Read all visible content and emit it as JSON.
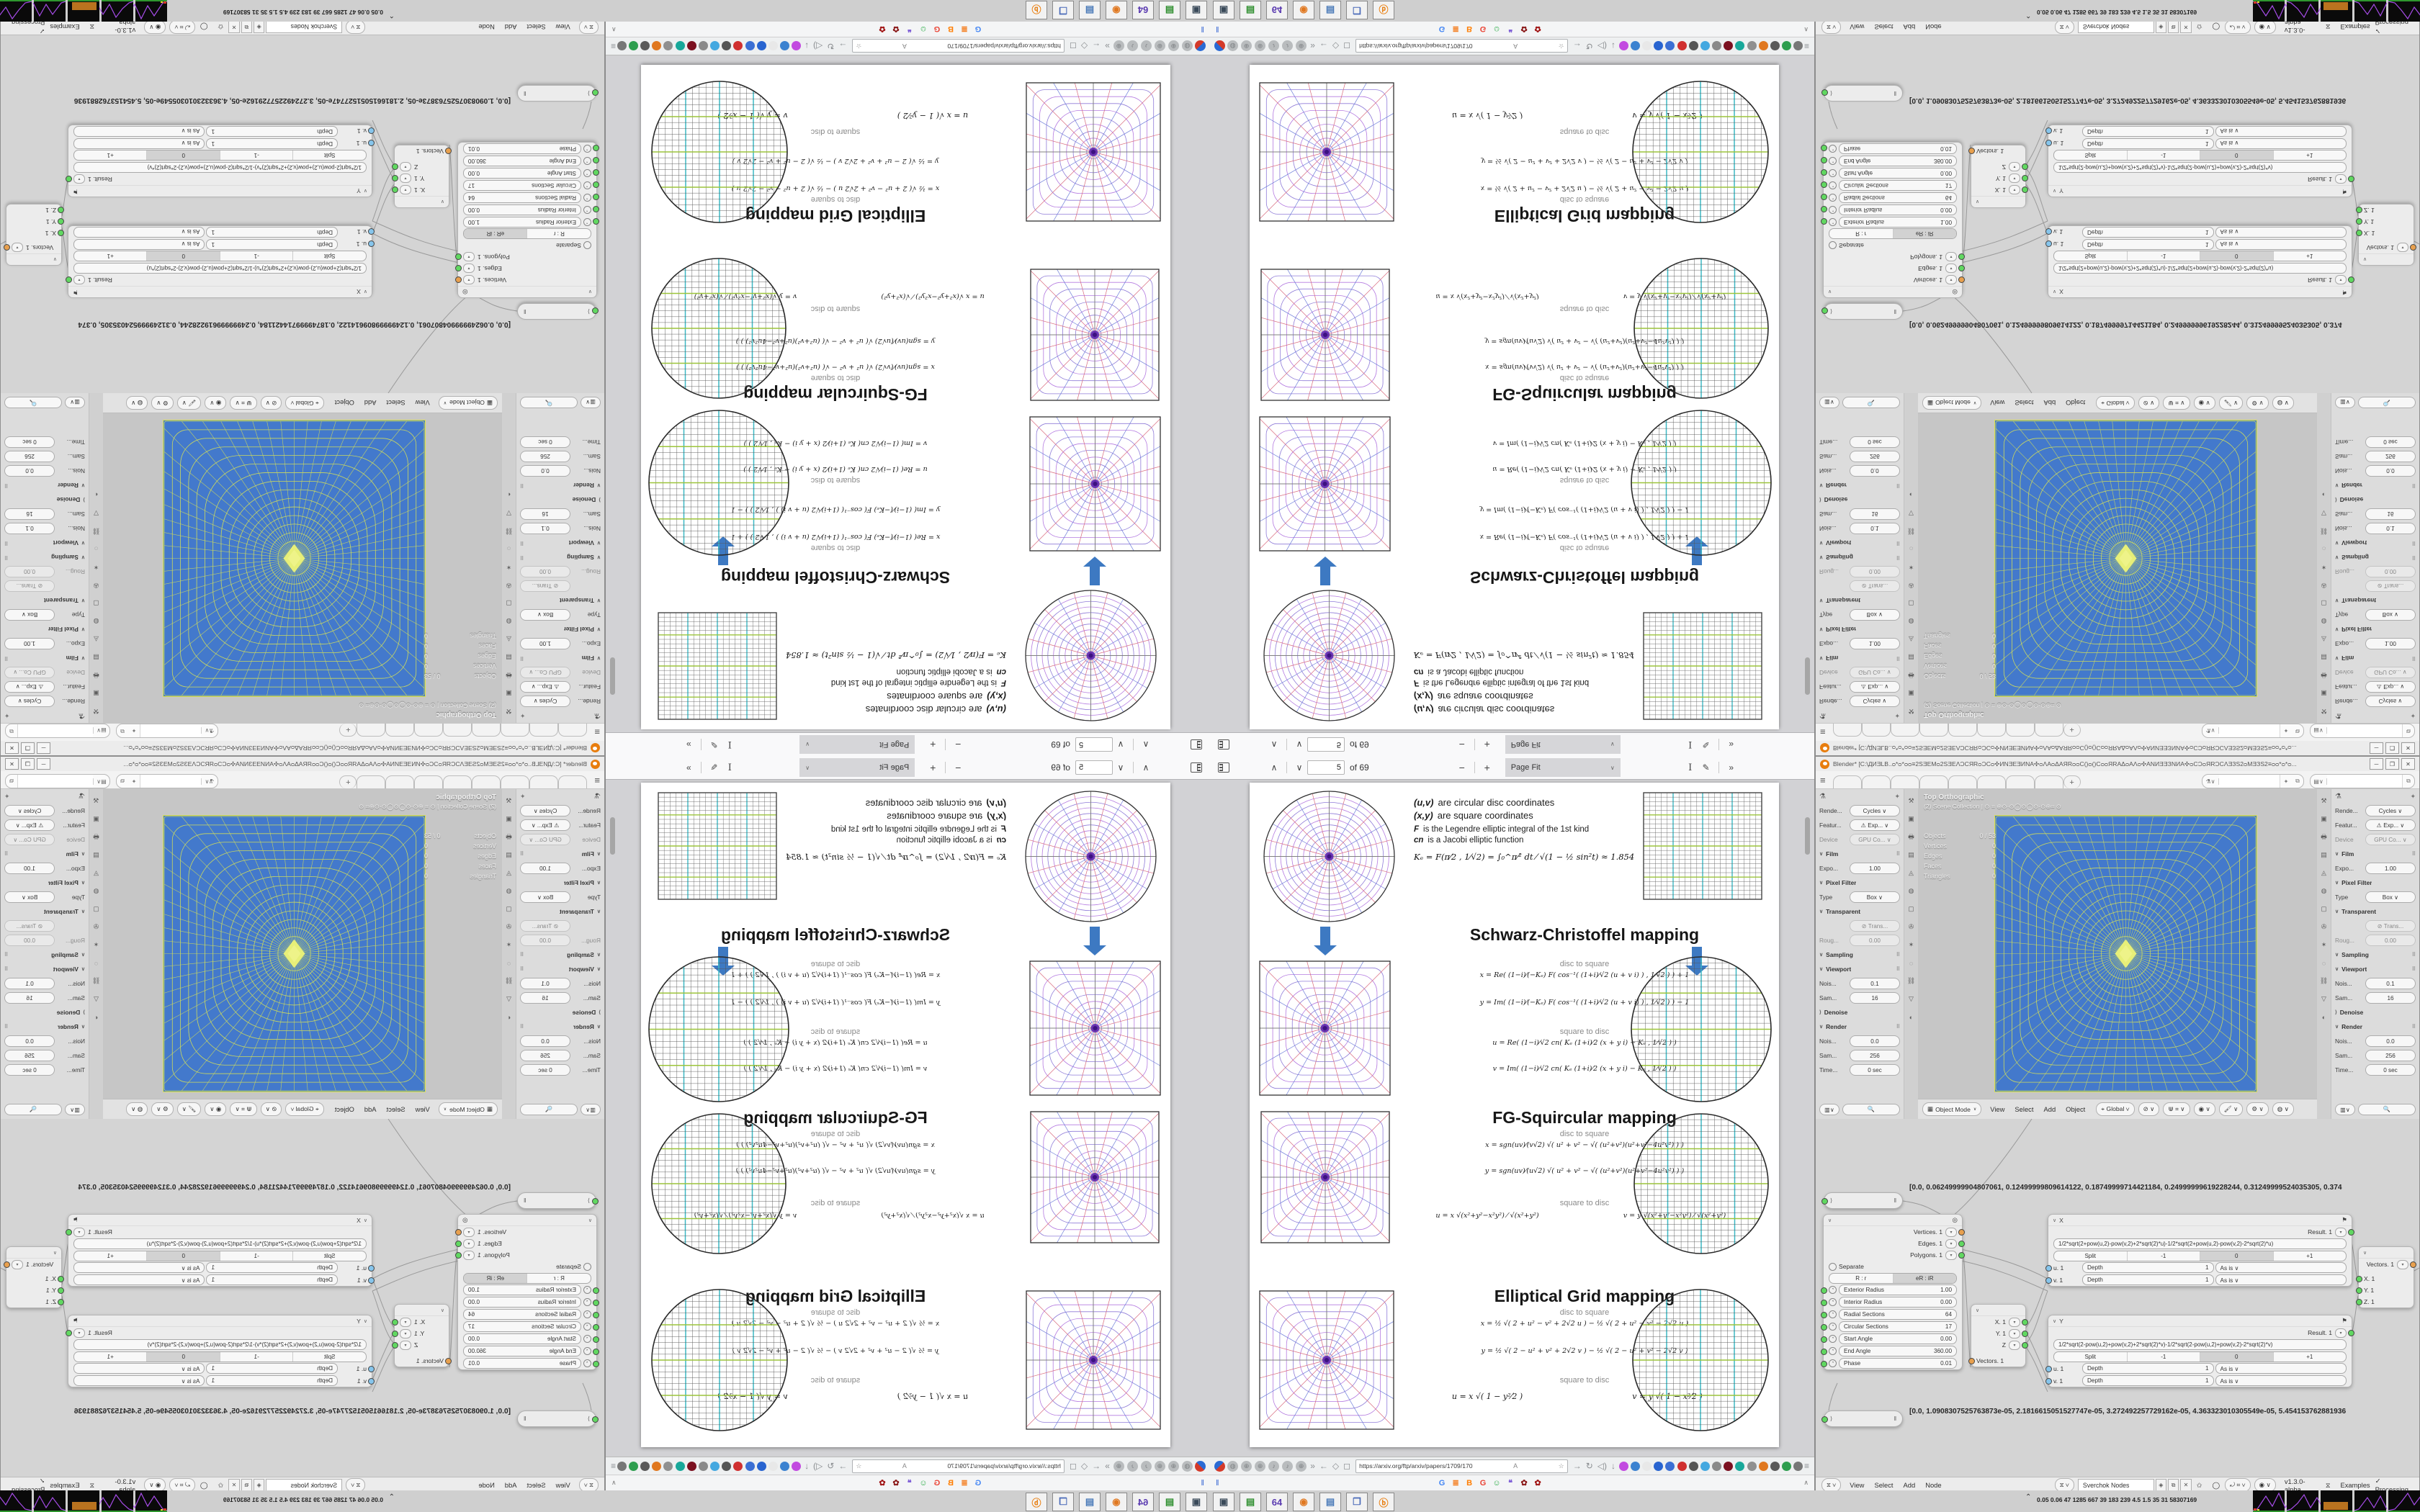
{
  "colors": {
    "accent_blue": "#3d79c2",
    "viewport_blue": "#4379cc",
    "wire": "#ccd95e",
    "wire_bright": "#e7ef78",
    "cyan": "#3bb8c4",
    "green": "#9cc43b",
    "ring_purple": "#8f7bd8",
    "ring_violet": "#b47ae0",
    "rad_red": "#d96b7e",
    "rad_blue": "#6b7bd9",
    "sel_yellow": "#dde24a"
  },
  "pdf": {
    "toolbar": {
      "page_value": "5",
      "page_total": "of 69",
      "zoom_value": "Page Fit"
    },
    "paper": {
      "defs": [
        {
          "lead": "(u,v)",
          "text": "are circular disc coordinates"
        },
        {
          "lead": "(x,y)",
          "text": "are square coordinates"
        },
        {
          "lead": "F",
          "text": "is the Legendre elliptic integral of the 1st kind"
        },
        {
          "lead": "cn",
          "text": "is a Jacobi elliptic function"
        }
      ],
      "ke": "Kₑ = F(π⁄2 , 1⁄√2) = ∫₀^π⁄²  dt ⁄ √(1 − ½ sin²t)  ≈ 1.854",
      "sections": [
        {
          "title": "Schwarz-Christoffel mapping",
          "d2s": "disc to square",
          "s2d": "square to disc",
          "fx": "x = Re( (1−i)⁄(−Kₑ) F( cos⁻¹( (1+i)⁄√2 (u + v i) ) , 1⁄√2 ) ) + 1",
          "fy": "y = Im( (1−i)⁄(−Kₑ) F( cos⁻¹( (1+i)⁄√2 (u + v i) ) , 1⁄√2 ) ) − 1",
          "fu": "u = Re( (1−i)⁄√2  cn( Kₑ (1+i)⁄2 (x + y i) − Kₑ , 1⁄√2 ) )",
          "fv": "v = Im( (1−i)⁄√2  cn( Kₑ (1+i)⁄2 (x + y i) − Kₑ , 1⁄√2 ) )"
        },
        {
          "title": "FG-Squircular mapping",
          "d2s": "disc to square",
          "s2d": "square to disc",
          "fx": "x = sgn(uv)⁄(v√2) √( u² + v² − √( (u²+v²)(u²+v²−4u²v²) ) )",
          "fy": "y = sgn(uv)⁄(u√2) √( u² + v² − √( (u²+v²)(u²+v²−4u²v²) ) )",
          "fu": "u = x √(x²+y²−x²y²) ⁄ √(x²+y²)",
          "fv": "v = y √(x²+y²−x²y²) ⁄ √(x²+y²)"
        },
        {
          "title": "Elliptical Grid mapping",
          "d2s": "disc to square",
          "s2d": "square to disc",
          "fx": "x = ½ √( 2 + u² − v² + 2√2 u )  −  ½ √( 2 + u² − v² − 2√2 u )",
          "fy": "y = ½ √( 2 − u² + v² + 2√2 v )  −  ½ √( 2 − u² + v² − 2√2 v )",
          "fu": "u = x √( 1 − y²⁄2 )",
          "fv": "v = y √( 1 − x²⁄2 )"
        }
      ]
    }
  },
  "browser": {
    "url": "https://arxiv.org/ftp/arxiv/papers/1709/170",
    "nav_left_icons": [
      "◍",
      "⊕",
      "⊕",
      "♪",
      "♪",
      "⊕"
    ],
    "ext_colors": [
      "#c24ae0",
      "#3b82d0",
      "#e8e8e8",
      "#2864d0",
      "#3b6fd4",
      "#d03030",
      "#555555",
      "#44a8e0",
      "#8a8a8a",
      "#7b1020",
      "#18a89a",
      "#909090",
      "#e07820",
      "#5a5a5a",
      "#2e9e4f",
      "#777777"
    ],
    "favicons": [
      {
        "t": "G",
        "c": "#4285F4"
      },
      {
        "t": "≣",
        "c": "#f48024"
      },
      {
        "t": "B",
        "c": "#ff7d00"
      },
      {
        "t": "G",
        "c": "#ea4335"
      },
      {
        "t": "☺",
        "c": "#2fae4a"
      },
      {
        "t": "❝",
        "c": "#7b5bd6"
      },
      {
        "t": "✿",
        "c": "#8b1a1a"
      },
      {
        "t": "✿",
        "c": "#a11616"
      }
    ],
    "bookmarks_pause": "‖",
    "bookmarks_expand": "∧"
  },
  "desktop": {
    "icons": [
      {
        "g": "▣",
        "c": "#3a4a5a",
        "name": "computer"
      },
      {
        "g": "▤",
        "c": "#2f8f2f",
        "name": "console"
      },
      {
        "g": "64",
        "c": "#5a3ab0",
        "name": "floppy-64"
      },
      {
        "g": "◉",
        "c": "#e07820",
        "name": "firefox"
      },
      {
        "g": "▤",
        "c": "#4a7ab8",
        "name": "notepad"
      },
      {
        "g": "❒",
        "c": "#4a6ab8",
        "name": "window"
      },
      {
        "g": "ⓑ",
        "c": "#e87d0d",
        "name": "blender"
      }
    ],
    "monitor_chevron": "⌃",
    "monitor_numbers": "0.05 0.06   47   1285 667   39   183   239   4.5   1.5   35   31   58307169"
  },
  "blender": {
    "title": "Blender* [C:\\ДИƎLB..ᴑ*ᴑ*ᴑᴑ≡2SƎEMᴑ2SƎEΛƆCЯRᴑƆCᴑ✣ИNƎEƎИNA✣ᴑΛAᴑΔAЯRᴑᴑC()ᴑ()CᴑᴑЯRAΔᴑAΛᴑ✣ANИƎƎЗNИA✣ᴑCƆᴑЯRƆCΛƎЗS2ᴑMƎЗS2≡ᴑᴑ*ᴑ*ᴑ...",
    "win_buttons": {
      "min": "─",
      "max": "❐",
      "close": "✕"
    },
    "topbar": {
      "menu": "≡",
      "tabs": [
        "",
        "",
        "",
        "",
        "",
        "",
        "",
        ""
      ],
      "plus": "+"
    },
    "props_rows": [
      {
        "cls": "crumb",
        "label": "",
        "value": ""
      },
      {
        "cls": "field",
        "label": "Rende...",
        "value": "Cycles ∨"
      },
      {
        "cls": "field",
        "label": "Featur...",
        "value": "⚠ Exp... ∨"
      },
      {
        "cls": "field dim",
        "label": "Device",
        "value": "GPU Co... ∨"
      },
      {
        "cls": "section",
        "label": "Film"
      },
      {
        "cls": "field",
        "label": "Expo...",
        "value": "1.00"
      },
      {
        "cls": "section plain",
        "label": "Pixel Filter"
      },
      {
        "cls": "field",
        "label": "Type",
        "value": "Box ∨"
      },
      {
        "cls": "section plain toggle",
        "label": "Transparent"
      },
      {
        "cls": "field dim",
        "label": "",
        "value": "⊘ Trans..."
      },
      {
        "cls": "field dim",
        "label": "Roug...",
        "value": "0.00"
      },
      {
        "cls": "section",
        "label": "Sampling"
      },
      {
        "cls": "section",
        "label": "Viewport"
      },
      {
        "cls": "field",
        "label": "Nois...",
        "value": "0.1"
      },
      {
        "cls": "field",
        "label": "Sam...",
        "value": "16"
      },
      {
        "cls": "section plain closed toggle",
        "label": "Denoise"
      },
      {
        "cls": "section",
        "label": "Render"
      },
      {
        "cls": "field",
        "label": "Nois...",
        "value": "0.0"
      },
      {
        "cls": "field",
        "label": "Sam...",
        "value": "256"
      },
      {
        "cls": "field",
        "label": "Time...",
        "value": "0 sec"
      }
    ],
    "prop_tabs": [
      "⚒",
      "▣",
      "🖶",
      "▤",
      "◬",
      "◍",
      "▢",
      "✇",
      "✶",
      "◌",
      "⛓",
      "▽",
      "◐"
    ],
    "props_header": {
      "search": "🔍"
    },
    "viewport": {
      "overlay1": "Top Orthographic",
      "overlay2": "(2) Scene Collection | ⊙ ⌗ ⊕⊙·⊙◯⊙◯⊙·⊙⊕⌗ ⊙",
      "stats": [
        [
          "Objects",
          "0 / 53"
        ],
        [
          "Vertices",
          "0"
        ],
        [
          "Edges",
          "0"
        ],
        [
          "Faces",
          "0"
        ],
        [
          "Triangles",
          "0"
        ]
      ],
      "mode": "Object Mode",
      "menus": [
        "View",
        "Select",
        "Add",
        "Object"
      ],
      "orient": "⌖ Global ∨",
      "pills": [
        "⊘ ∨",
        "⋓ ⌗ ∨",
        "◉ ∨",
        "🖌 ∨",
        "⚙ ∨",
        "◍ ∨"
      ]
    },
    "nodes": {
      "ring": {
        "outputs": [
          {
            "n": "Vertices. 1",
            "s": "orange"
          },
          {
            "n": "Edges. 1",
            "s": "green"
          },
          {
            "n": "Polygons. 1",
            "s": "green"
          }
        ],
        "separate": "Separate",
        "seg": [
          "R : r",
          "eR : iR"
        ],
        "params": [
          [
            "Exterior Radius",
            "1.00"
          ],
          [
            "Interior Radius",
            "0.00"
          ],
          [
            "Radial Sections",
            "64"
          ],
          [
            "Circular Sections",
            "17"
          ],
          [
            "Start Angle",
            "0.00"
          ],
          [
            "End Angle",
            "360.00"
          ],
          [
            "Phase",
            "0.01"
          ]
        ]
      },
      "xnode": {
        "title": "X",
        "result": "Result. 1",
        "formula": "1/2*sqrt(2+pow(u,2)-pow(v,2)+2*sqrt(2)*u)-1/2*sqrt(2+pow(u,2)-pow(v,2)-2*sqrt(2)*u)",
        "seg": [
          "Split",
          "-1",
          "0",
          "+1"
        ],
        "rows": [
          {
            "s": "u. 1",
            "d": "Depth",
            "dv": "1",
            "m": "As is ∨"
          },
          {
            "s": "v. 1",
            "d": "Depth",
            "dv": "1",
            "m": "As is ∨"
          }
        ]
      },
      "ynode": {
        "title": "Y",
        "result": "Result. 1",
        "formula": "1/2*sqrt(2-pow(u,2)+pow(v,2)+2*sqrt(2)*v)-1/2*sqrt(2-pow(u,2)+pow(v,2)-2*sqrt(2)*v)",
        "seg": [
          "Split",
          "-1",
          "0",
          "+1"
        ],
        "rows": [
          {
            "s": "u. 1",
            "d": "Depth",
            "dv": "1",
            "m": "As is ∨"
          },
          {
            "s": "v. 1",
            "d": "Depth",
            "dv": "1",
            "m": "As is ∨"
          }
        ]
      },
      "vecout": {
        "x": "X. 1",
        "y": "Y. 1",
        "z": "Z",
        "vec": "Vectors. 1"
      },
      "vecin": {
        "vec": "Vectors. 1",
        "x": "X. 1",
        "y": "Y. 1",
        "z": "Z. 1"
      },
      "numstr1": "[0.0, 0.06249999904807061, 0.12499999809614122, 0.18749999714421184, 0.24999999619228244, 0.31249999524035305, 0.374",
      "numstr2": "[0.0, 1.0908307525763873e-05, 2.1816615051527747e-05, 3.272492257729162e-05, 4.363323010305549e-05, 5.454153762881936"
    },
    "nodebar": {
      "menus": [
        "View",
        "Select",
        "Add",
        "Node"
      ],
      "tree": "Sverchok Nodes",
      "version": "v1.3.0-alpha",
      "examples": "Examples",
      "processing": "✓ Processing"
    }
  }
}
